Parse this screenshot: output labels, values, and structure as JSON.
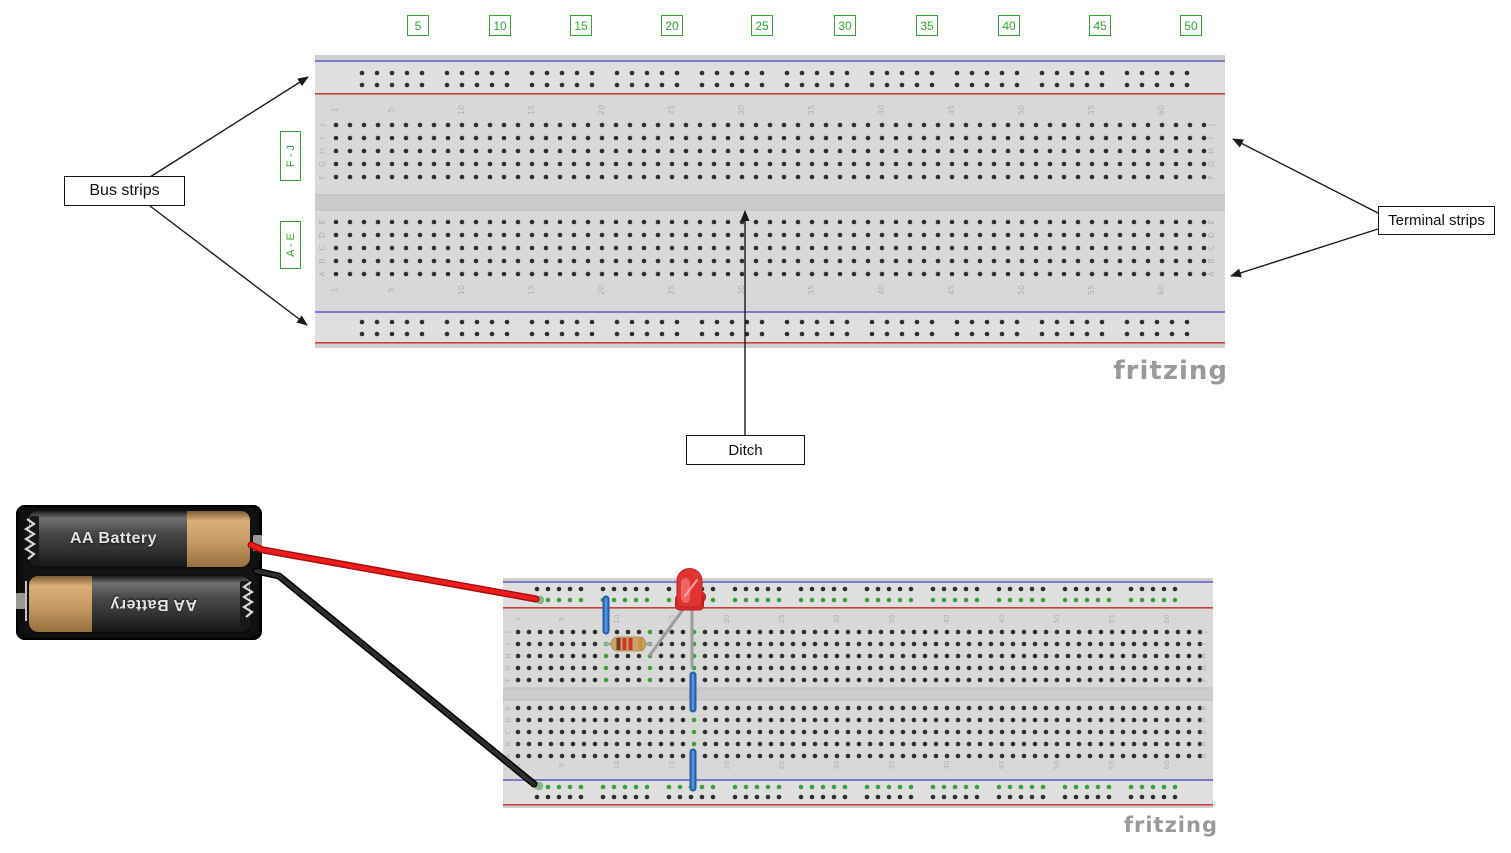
{
  "figure1": {
    "callout_bus_strips": "Bus strips",
    "callout_terminal_strips": "Terminal strips",
    "callout_ditch": "Ditch",
    "row_range_top_label": "F - J",
    "row_range_bottom_label": "A - E",
    "column_markers": [
      "5",
      "10",
      "15",
      "20",
      "25",
      "30",
      "35",
      "40",
      "45",
      "50"
    ],
    "watermark": "fritzing"
  },
  "figure2": {
    "watermark": "fritzing",
    "battery_pack": {
      "battery_top_label": "AA Battery",
      "battery_bottom_label": "AA Battery"
    }
  },
  "breadboard_labels": {
    "column_numbers": [
      "1",
      "5",
      "10",
      "15",
      "20",
      "25",
      "30",
      "35",
      "40",
      "45",
      "50",
      "55",
      "60"
    ],
    "column_number_positions": [
      1,
      5,
      10,
      15,
      20,
      25,
      30,
      35,
      40,
      45,
      50,
      55,
      60
    ],
    "row_letters_top_block": [
      "J",
      "I",
      "H",
      "G",
      "F"
    ],
    "row_letters_bottom_block": [
      "E",
      "D",
      "C",
      "B",
      "A"
    ]
  },
  "components": {
    "led": {
      "name": "red-led",
      "color": "#e23232"
    },
    "resistor": {
      "name": "resistor",
      "body_color": "#c8a468",
      "band_colors": [
        "#7d3722",
        "#cf3527",
        "#cf3527",
        "#c89140"
      ]
    },
    "jumper_wires": {
      "count": 3,
      "color": "#2a6fc2"
    },
    "battery_wires": [
      {
        "name": "positive-wire",
        "color": "#e81515"
      },
      {
        "name": "negative-wire",
        "color": "#111111"
      }
    ]
  },
  "colors": {
    "board_body": "#d8d8d8",
    "bus_area": "#dfdfdf",
    "ditch": "#cbcbcb",
    "rail_blue": "#7b7bc8",
    "rail_red": "#c84040",
    "hole": "#2e2e2e",
    "connected_hole": "#3ba03b",
    "faint_label": "#b2b2b2",
    "callout_green": "#2fa52f",
    "watermark_gray": "#9a9a9a"
  }
}
